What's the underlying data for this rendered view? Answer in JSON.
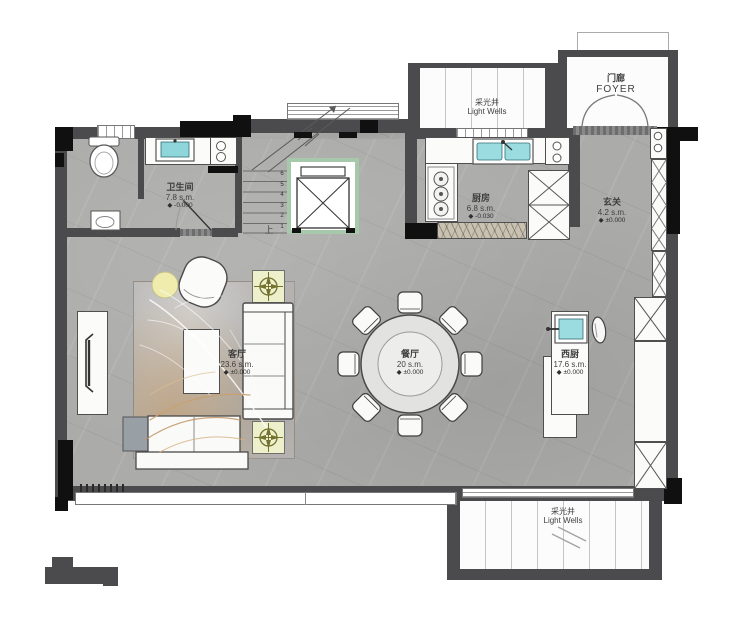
{
  "title": "residential floor plan",
  "rooms": {
    "bathroom": {
      "name": "卫生间",
      "area": "7.8 s.m.",
      "elevation": "◆ -0.000"
    },
    "kitchen": {
      "name": "厨房",
      "area": "6.8 s.m.",
      "elevation": "◆ -0.030"
    },
    "entry": {
      "name": "玄关",
      "area": "4.2 s.m.",
      "elevation": "◆ ±0.000"
    },
    "living": {
      "name": "客厅",
      "area": "23.6 s.m.",
      "elevation": "◆ ±0.000"
    },
    "dining": {
      "name": "餐厅",
      "area": "20 s.m.",
      "elevation": "◆ ±0.000"
    },
    "west_kitchen": {
      "name": "西厨",
      "area": "17.6 s.m.",
      "elevation": "◆ ±0.000"
    },
    "foyer": {
      "name_cn": "门廊",
      "name_en": "FOYER"
    },
    "light_well_top": {
      "name_cn": "采光井",
      "name_en": "Light Wells"
    },
    "light_well_bottom": {
      "name_cn": "采光井",
      "name_en": "Light Wells"
    }
  },
  "stairs": {
    "up_label": "上",
    "step_numbers": [
      "1",
      "2",
      "3",
      "4",
      "5",
      "6"
    ]
  },
  "colors": {
    "wall": "#4b4b4d",
    "wall_black": "#101010",
    "floor": "#ababa9",
    "water_fixture": "#8fd6da",
    "elevator_frame": "#a6c9ac",
    "plant_table": "#eef0cc",
    "label_text": "#3f3f3f"
  }
}
